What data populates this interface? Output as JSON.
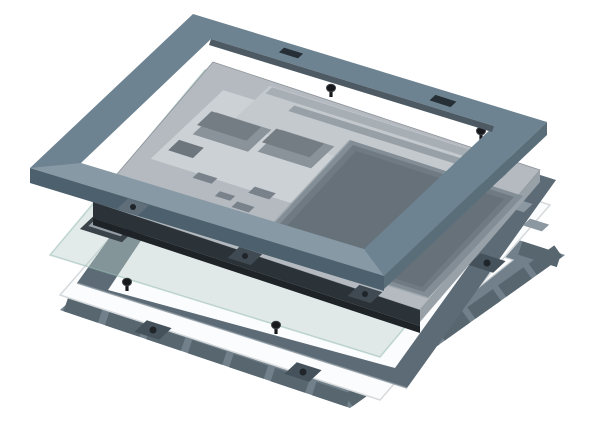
{
  "figure": {
    "kind": "cad-exploded-assembly-diagram",
    "background": "#ffffff",
    "layer_names": [
      "front-bezel-frame",
      "touch-glass-sheet",
      "lcd-module-chassis",
      "back-cover-tray",
      "rear-mounting-frame",
      "diffuser-sheet",
      "gasket-frame"
    ],
    "screw_count": 4,
    "gasket": {
      "tiles_per_edge": 7
    },
    "colors": {
      "bezel": "#6d8391",
      "bezelLip": "#4d5a64",
      "bezelSkirt": "#4c616d",
      "bezelSkirtRight": "#5a6e7a",
      "bezelSlot": "#262f36",
      "bezelBoss": "#5f6e79",
      "plate": "#b4bac0",
      "plateEdge": "#99a1a8",
      "subplate": "#ccd1d5",
      "shield": "#c3c9cd",
      "barLight": "#a7aeb4",
      "barMid": "#98a0a7",
      "connector": "#8a939a",
      "connectorTop": "#747d84",
      "connectorSmall": "#6d767d",
      "chip": "#79828a",
      "pad": "#d0d4d7",
      "padDark": "#8f979e",
      "bracket": "#6f7881",
      "pcbBox": "#3a434a",
      "pcbInner": "#969ea5",
      "blue": "#2e3ed2",
      "railDark": "#2c3338",
      "railSkirt": "#1e2327",
      "lug": "#3f4a52",
      "slab": "#828d95",
      "slabMid": "#6f7a83",
      "slabTop": "#667179",
      "slabHighlight": "#a0a9b0",
      "rearFrame": "#5c6b76",
      "rearTab": "#45525c",
      "rearCutout": "#8c98a1",
      "sheet": "#fbfcfd",
      "sheetEdge": "#d5d9db",
      "gasket": "#697984",
      "gasketTile": "#57666f",
      "gasketRim": "#c9d0d4",
      "glass": "#b9d0ca",
      "glassEdge": "#96bab2",
      "screw": "#17191c",
      "screwRim": "#3c4146",
      "hole": "#1f2529"
    }
  }
}
